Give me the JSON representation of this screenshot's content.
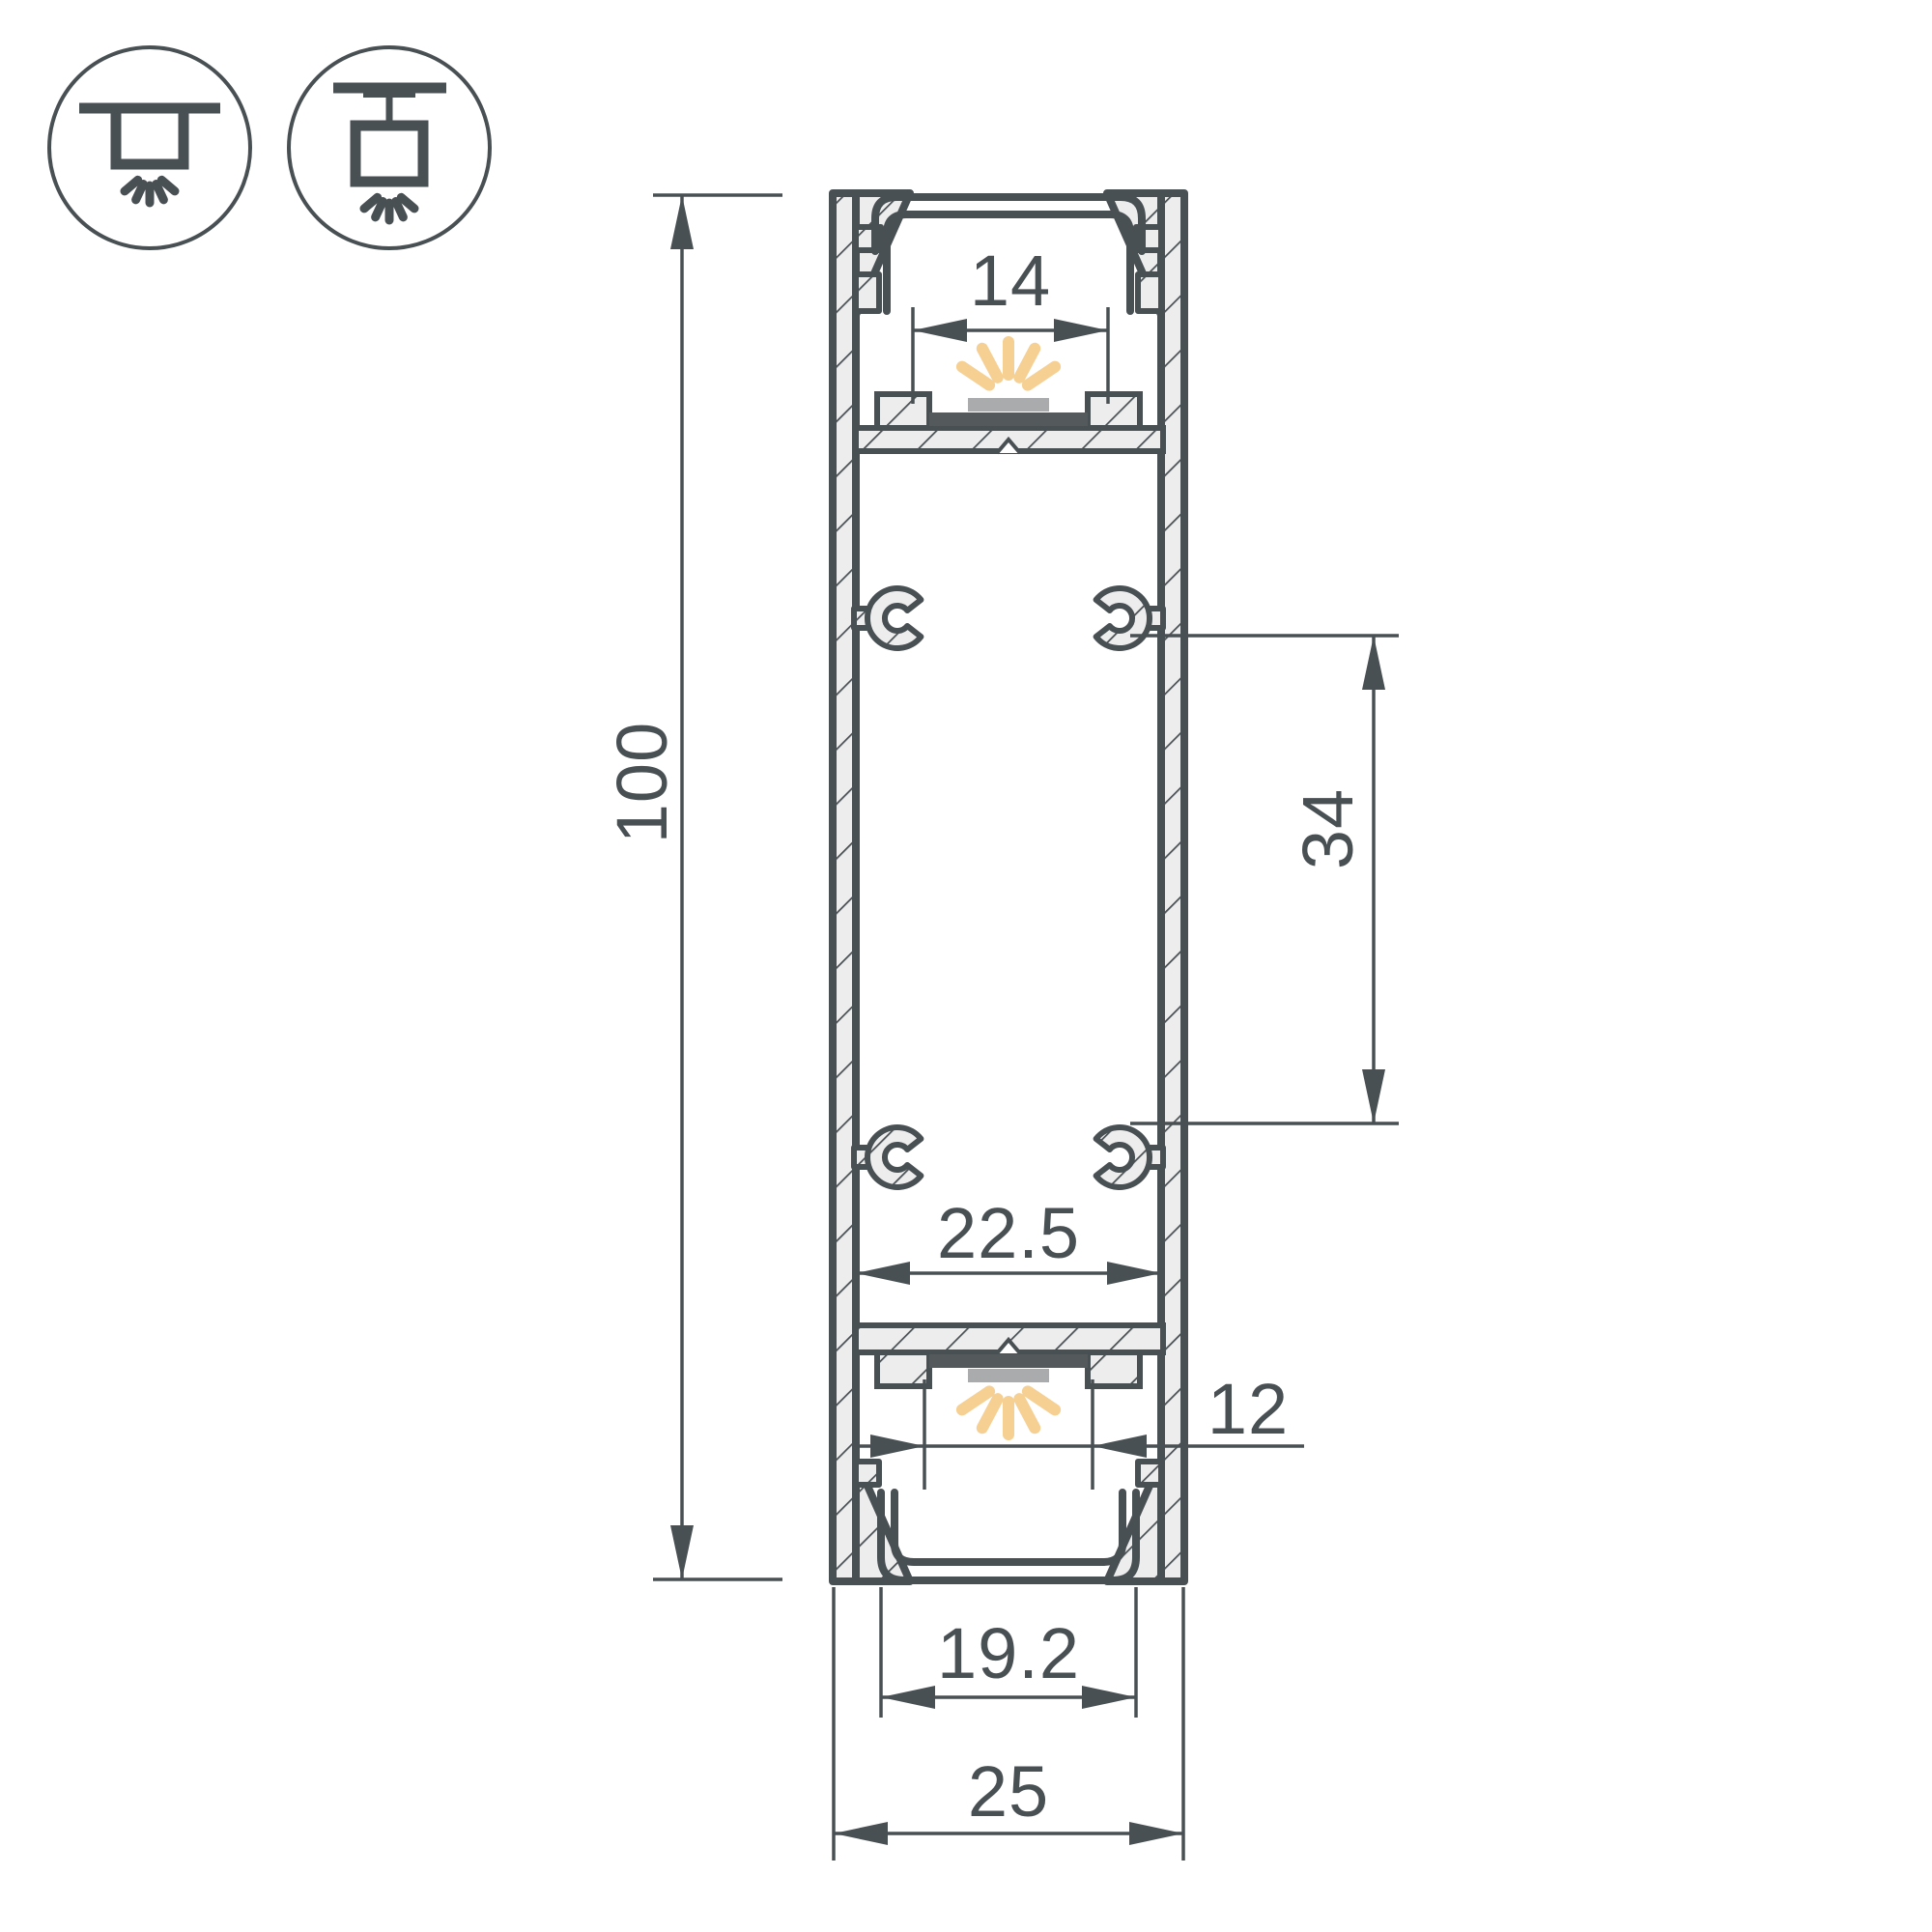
{
  "drawing": {
    "type": "technical-cross-section",
    "subject": "aluminium LED profile cross-section with mounting icons and dimensions",
    "colors": {
      "line": "#495054",
      "hatch_fill": "#ededed",
      "glow": "#f6cf92",
      "led_pad": "#a9abac",
      "led_strip": "#54595c",
      "background": "#ffffff"
    },
    "icons": [
      {
        "name": "recessed-mount-icon"
      },
      {
        "name": "surface-mount-icon"
      }
    ],
    "dimensions": {
      "overall_height": {
        "label": "100",
        "orientation": "vertical"
      },
      "top_channel_width": {
        "label": "14",
        "orientation": "horizontal"
      },
      "clip_spacing": {
        "label": "34",
        "orientation": "vertical"
      },
      "inner_width": {
        "label": "22.5",
        "orientation": "horizontal"
      },
      "bottom_led_width": {
        "label": "12",
        "orientation": "horizontal"
      },
      "diffuser_width": {
        "label": "19.2",
        "orientation": "horizontal"
      },
      "overall_width": {
        "label": "25",
        "orientation": "horizontal"
      }
    }
  }
}
